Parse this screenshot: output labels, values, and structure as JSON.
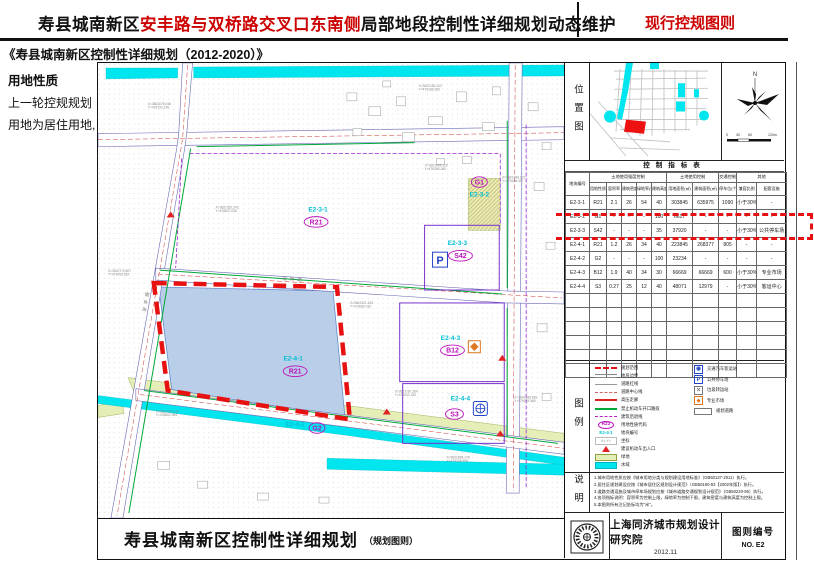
{
  "header": {
    "title_part1": "寿县城南新区",
    "title_part2": "安丰路与双桥路交叉口东南侧",
    "title_part3": "局部地段控制性详细规划动态维护",
    "badge": "现行控规图则",
    "subtitle": "《寿县城南新区控制性详细规划（2012-2020）》"
  },
  "sidebar": {
    "heading": "用地性质",
    "line1": "上一轮控规规划",
    "line2": "用地为居住用地,"
  },
  "map": {
    "title": "寿县城南新区控制性详细规划",
    "title_note": "（规划图则）",
    "road_names": {
      "left_road": "安丰路",
      "bottom_road": "双桥路"
    },
    "parcels": [
      {
        "code": "E2-3-1",
        "cx": 221,
        "cy": 149,
        "zone": "R21",
        "zx": 219,
        "zy": 162,
        "ew": 24
      },
      {
        "code": "E2-3-2",
        "cx": 383,
        "cy": 134,
        "zone": "G1",
        "zx": 383,
        "zy": 122,
        "ew": 16
      },
      {
        "code": "E2-3-3",
        "cx": 361,
        "cy": 183,
        "zone": "S42",
        "zx": 364,
        "zy": 196,
        "ew": 24
      },
      {
        "code": "E2-4-1",
        "cx": 196,
        "cy": 299,
        "zone": "R21",
        "zx": 198,
        "zy": 312,
        "ew": 24
      },
      {
        "code": "E2-4-2",
        "cx": 198,
        "cy": 365,
        "zone": "G2",
        "zx": 220,
        "zy": 369,
        "ew": 16
      },
      {
        "code": "E2-4-3",
        "cx": 354,
        "cy": 278,
        "zone": "B12",
        "zx": 356,
        "zy": 291,
        "ew": 24
      },
      {
        "code": "E2-4-4",
        "cx": 364,
        "cy": 339,
        "zone": "S3",
        "zx": 358,
        "zy": 355,
        "ew": 18
      }
    ],
    "coords": [
      {
        "x": 50,
        "y": 42,
        "a": "X=3602075.048",
        "b": "Y=478792.376"
      },
      {
        "x": 322,
        "y": 24,
        "a": "X=3602160.103",
        "b": "Y=479163.260"
      },
      {
        "x": 118,
        "y": 146,
        "a": "X=3601952.243",
        "b": "Y=478827.036"
      },
      {
        "x": 328,
        "y": 104,
        "a": "X=3601944.120",
        "b": "Y=479283.260"
      },
      {
        "x": 253,
        "y": 242,
        "a": "X=3601921.154",
        "b": "Y=479065.410"
      },
      {
        "x": 406,
        "y": 116,
        "a": "X=3601948.873",
        "b": "Y=479486.457"
      },
      {
        "x": 10,
        "y": 210,
        "a": "X=3601770.807",
        "b": "Y=478705.552"
      },
      {
        "x": 298,
        "y": 331,
        "a": "X=3601787.364",
        "b": "Y=479042.150"
      },
      {
        "x": 58,
        "y": 351,
        "a": "X=3601707.140",
        "b": "Y=478602.964"
      },
      {
        "x": 350,
        "y": 397,
        "a": "X=3601665.178",
        "b": "Y=479238.998"
      },
      {
        "x": 418,
        "y": 337,
        "a": "X=3601688.581",
        "b": "Y=479078.985"
      }
    ]
  },
  "panel": {
    "location": {
      "heading": "位置图",
      "north": "N",
      "scale_labels": [
        "0",
        "30",
        "60",
        "120m"
      ]
    },
    "table": {
      "title": "控制指标表",
      "groups": [
        {
          "label": "地块编号",
          "rowspan": 2
        },
        {
          "label": "土地使用强度控制",
          "colspan": 5
        },
        {
          "label": "土地使用控制",
          "colspan": 2
        },
        {
          "label": "交通控制",
          "colspan": 1
        },
        {
          "label": "其他",
          "colspan": 2
        }
      ],
      "columns": [
        "用地性质",
        "容积率",
        "建筑密度(%)",
        "绿地率(%)",
        "建筑高度(m)",
        "用地面积(㎡)",
        "建筑面积(㎡)",
        "停车位(个)",
        "兼容比例",
        "配套设施"
      ],
      "rows": [
        [
          "E2-3-1",
          "R21",
          "2.1",
          "26",
          "54",
          "40",
          "303845",
          "635975",
          "1090",
          "小于30%",
          "-"
        ],
        [
          "E2-3-2",
          "G1",
          "-",
          "-",
          "-",
          "100",
          "6617",
          "-",
          "-",
          "-",
          "-"
        ],
        [
          "E2-3-3",
          "S42",
          "-",
          "-",
          "-",
          "35",
          "37920",
          "-",
          "-",
          "小于30%",
          "公共停车场"
        ],
        [
          "E2-4-1",
          "R21",
          "1.2",
          "26",
          "34",
          "40",
          "223845",
          "268377",
          "805",
          "-",
          "-"
        ],
        [
          "E2-4-2",
          "G2",
          "-",
          "-",
          "-",
          "100",
          "23234",
          "-",
          "-",
          "-",
          "-"
        ],
        [
          "E2-4-3",
          "B12",
          "1.9",
          "40",
          "34",
          "30",
          "66669",
          "66669",
          "600",
          "小于30%",
          "专业市场"
        ],
        [
          "E2-4-4",
          "S3",
          "0.27",
          "25",
          "12",
          "40",
          "48071",
          "12979",
          "-",
          "小于30%",
          "客运中心"
        ]
      ],
      "highlighted_row": "E2-3-3"
    },
    "legend": {
      "heading": "图例",
      "left": [
        {
          "icon": "red-dashed-line",
          "label": "规划范围"
        },
        {
          "icon": "double-line",
          "label": "地块边界"
        },
        {
          "icon": "thin-line",
          "label": "道路红线"
        },
        {
          "icon": "center-line",
          "label": "道路中心线"
        },
        {
          "icon": "red-line",
          "label": "高压走廊"
        },
        {
          "icon": "green-line",
          "label": "禁止机动车开口路段"
        },
        {
          "icon": "magenta-dashed-line",
          "label": "建筑后退线"
        },
        {
          "icon": "zone-code",
          "symbol": "R22",
          "label": "用地性质代码"
        },
        {
          "icon": "parcel-code",
          "symbol": "E2-4-1",
          "label": "地块编号"
        },
        {
          "icon": "coord-mark",
          "symbol": "X= Y=",
          "label": "坐标"
        },
        {
          "icon": "red-triangle",
          "label": "建议机动车出入口"
        },
        {
          "icon": "green-fill",
          "label": "绿地"
        },
        {
          "icon": "cyan-fill",
          "label": "水域"
        }
      ],
      "right": [
        {
          "icon": "bus-station",
          "label": "交通汽车客运站"
        },
        {
          "icon": "parking",
          "symbol": "P",
          "label": "公共停车场"
        },
        {
          "icon": "sanitation",
          "label": "垃圾转运站"
        },
        {
          "icon": "market",
          "label": "专业市场"
        },
        {
          "icon": "empty-rect",
          "label": "规划道路"
        }
      ]
    },
    "notes": {
      "heading": "说明",
      "items": [
        "1.城市用地性质应按《城市用地分类与规划建设用地标准》（GB50137-2011）执行。",
        "2.居住区规划建设应按《城市居住区规划设计规范》（GB50180-93【2002年版】）执行。",
        "3.道路交通设施及城市停车场规划应按《城市道路交通规划设计规范》（GB50220-95）执行。",
        "4.各项指标说明：容积率为控制上限，绿地率为控制下限，建筑密度与建筑高度为控制上限。",
        "5.本图则所有注记坐标均为\"米\"。"
      ]
    },
    "footer": {
      "institute": "上海同济城市规划设计研究院",
      "date": "2012.11",
      "sheet_label": "图则编号",
      "sheet_no": "NO. E2"
    }
  },
  "colors": {
    "accent_red": "#cc0000",
    "boundary_red": "#e81111",
    "water_cyan": "#00e5ee",
    "parcel_blue": "#b9cfe9",
    "green_space": "#e6eeb8",
    "zone_magenta": "#bb11bb",
    "code_cyan": "#00bfd4"
  }
}
